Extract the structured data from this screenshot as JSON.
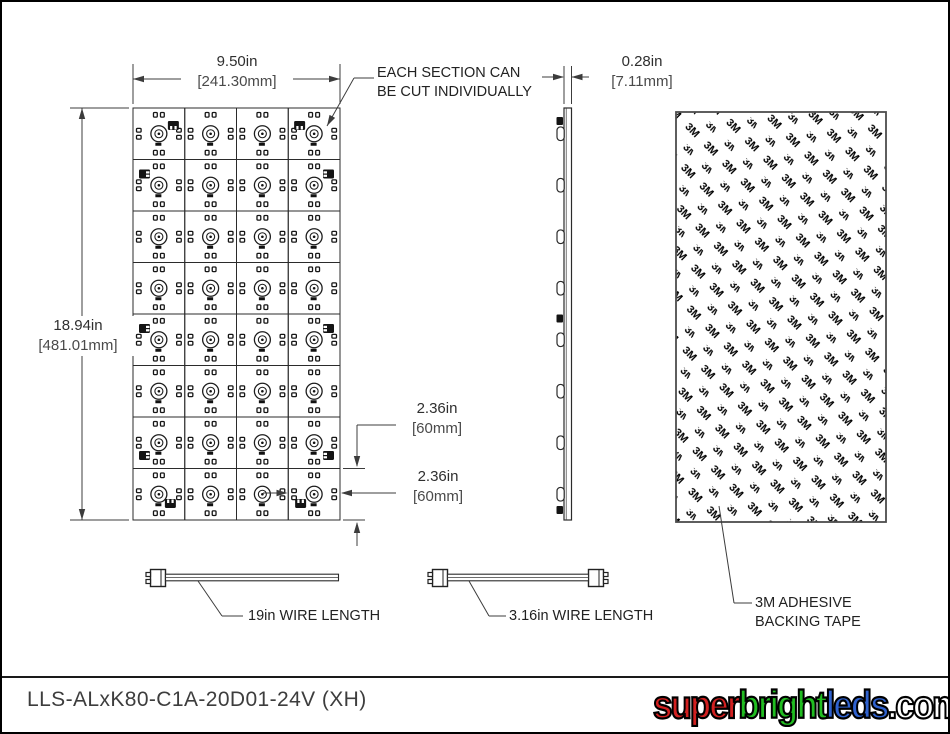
{
  "front_view": {
    "rows": 8,
    "cols": 4,
    "connectors": [
      {
        "row": 0,
        "col": 0,
        "pos": "top-right"
      },
      {
        "row": 0,
        "col": 3,
        "pos": "top-left"
      },
      {
        "row": 1,
        "col": 0,
        "pos": "left-top"
      },
      {
        "row": 1,
        "col": 3,
        "pos": "right-top"
      },
      {
        "row": 4,
        "col": 0,
        "pos": "left-top"
      },
      {
        "row": 4,
        "col": 3,
        "pos": "right-top"
      },
      {
        "row": 6,
        "col": 0,
        "pos": "left-bottom"
      },
      {
        "row": 6,
        "col": 3,
        "pos": "right-bottom"
      },
      {
        "row": 7,
        "col": 0,
        "pos": "bottom-right"
      },
      {
        "row": 7,
        "col": 3,
        "pos": "bottom-left"
      }
    ],
    "dims": {
      "width_in": "9.50in",
      "width_mm": "[241.30mm]",
      "height_in": "18.94in",
      "height_mm": "[481.01mm]",
      "row_pitch_in": "2.36in",
      "row_pitch_mm": "[60mm]",
      "col_pitch_in": "2.36in",
      "col_pitch_mm": "[60mm]"
    },
    "callout": [
      "EACH SECTION CAN",
      "BE CUT INDIVIDUALLY"
    ]
  },
  "side_view": {
    "dims": {
      "thickness_in": "0.28in",
      "thickness_mm": "[7.11mm]"
    }
  },
  "back_view": {
    "label": [
      "3M ADHESIVE",
      "BACKING TAPE"
    ],
    "pattern_text": "3M"
  },
  "wires": [
    {
      "label": "19in WIRE LENGTH"
    },
    {
      "label": "3.16in WIRE LENGTH"
    }
  ],
  "title_block": {
    "part_number": "LLS-ALxK80-C1A-20D01-24V (XH)"
  },
  "logo": {
    "segments": [
      {
        "text": "super",
        "color": "#d22020"
      },
      {
        "text": "bright",
        "color": "#21bd21"
      },
      {
        "text": "leds",
        "color": "#2f62cf"
      },
      {
        "text": ".com",
        "color": "#ffffff"
      }
    ]
  }
}
